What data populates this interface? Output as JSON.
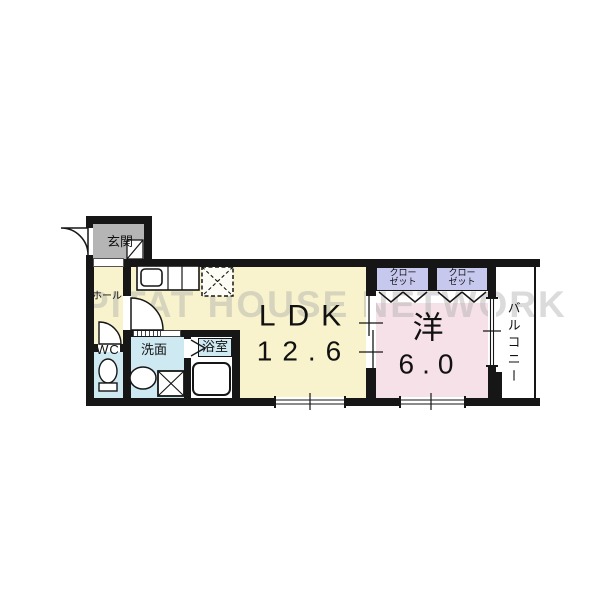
{
  "watermark": {
    "text": "PITAT HOUSE NETWORK"
  },
  "plan": {
    "type": "apartment-floor-plan",
    "rooms": {
      "genkan": {
        "label": "玄関"
      },
      "hall": {
        "label": "ホール"
      },
      "wc": {
        "label": "WC"
      },
      "washroom": {
        "label": "洗面"
      },
      "bathroom": {
        "label": "浴室"
      },
      "ldk": {
        "label": "LDK",
        "size": "12.6"
      },
      "western_room": {
        "label": "洋",
        "size": "6.0"
      },
      "closet_left": {
        "label_line1": "クロー",
        "label_line2": "ゼット"
      },
      "closet_right": {
        "label_line1": "クロー",
        "label_line2": "ゼット"
      },
      "balcony": {
        "label": "バルコニー"
      }
    },
    "fixtures": {
      "entrance_door": "swing-door-icon",
      "hall_door": "swing-door-icon",
      "wc_door": "swing-door-icon",
      "bathroom_door": "folding-door-icon",
      "washroom_door": "sliding-door-icon",
      "shoe_cabinet": "shoe-cabinet-icon",
      "kitchen_counter": "kitchen-counter-icon",
      "kitchen_sink": "sink-icon",
      "refrigerator_space": "refrigerator-space-icon",
      "toilet": "toilet-icon",
      "washbasin": "washbasin-icon",
      "washing_machine_space": "washing-machine-icon",
      "bathtub": "bathtub-icon",
      "closet_doors": "bifold-door-icon",
      "room_partition": "sliding-door-icon",
      "balcony_window": "sliding-window-icon",
      "bottom_windows": "window-icon",
      "balcony_railing": "railing-icon"
    }
  },
  "colors": {
    "wall": "#161616",
    "floor_ldk": "#f8f3cd",
    "floor_western": "#f6e1e8",
    "floor_wet_area": "#cfe9f2",
    "floor_genkan": "#b5b5b5",
    "closet": "#c7c8ee",
    "watermark": "#ababab",
    "background": "#ffffff"
  }
}
